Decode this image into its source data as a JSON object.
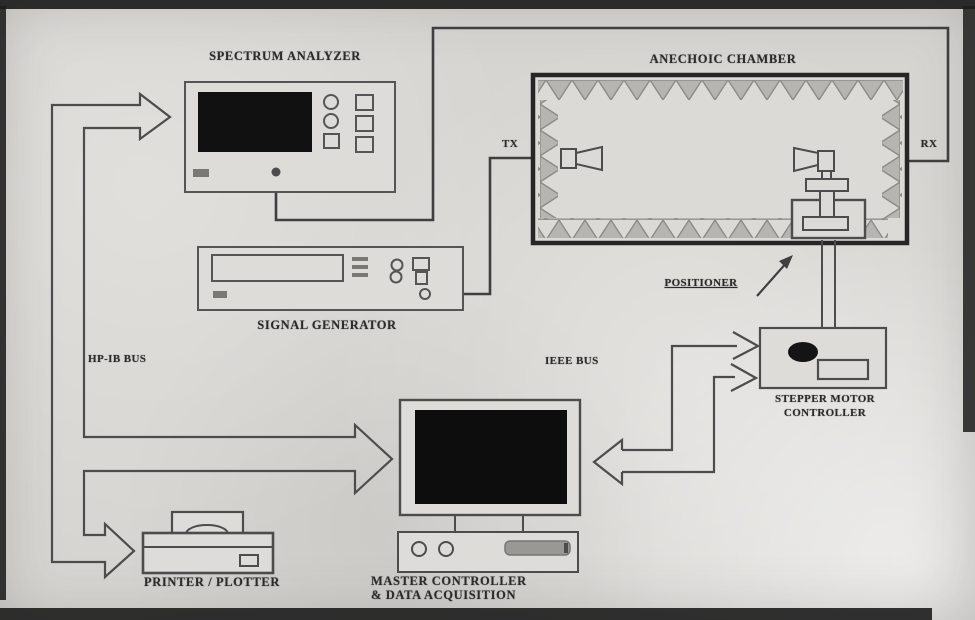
{
  "figure": {
    "labels": {
      "spectrum_analyzer": "SPECTRUM ANALYZER",
      "anechoic_chamber": "ANECHOIC CHAMBER",
      "tx": "TX",
      "rx": "RX",
      "signal_generator": "SIGNAL GENERATOR",
      "positioner": "POSITIONER",
      "hpib_bus": "HP-IB BUS",
      "ieee_bus": "IEEE BUS",
      "stepper_motor_line1": "STEPPER MOTOR",
      "stepper_motor_line2": "CONTROLLER",
      "master_controller_line1": "MASTER CONTROLLER",
      "master_controller_line2": "& DATA ACQUISITION",
      "printer_plotter": "PRINTER / PLOTTER"
    },
    "nodes": [
      {
        "id": "spectrum_analyzer",
        "label": "SPECTRUM ANALYZER"
      },
      {
        "id": "anechoic_chamber",
        "label": "ANECHOIC CHAMBER"
      },
      {
        "id": "tx_antenna",
        "label": "TX"
      },
      {
        "id": "rx_antenna",
        "label": "RX"
      },
      {
        "id": "signal_generator",
        "label": "SIGNAL GENERATOR"
      },
      {
        "id": "positioner",
        "label": "POSITIONER"
      },
      {
        "id": "stepper_motor_controller",
        "label": "STEPPER MOTOR CONTROLLER"
      },
      {
        "id": "master_controller",
        "label": "MASTER CONTROLLER & DATA ACQUISITION"
      },
      {
        "id": "printer_plotter",
        "label": "PRINTER / PLOTTER"
      }
    ],
    "connections": [
      {
        "from": "hp_ib_bus",
        "to": "spectrum_analyzer",
        "type": "hollow-bus-arrow"
      },
      {
        "from": "hp_ib_bus",
        "to": "master_controller",
        "type": "hollow-bus-arrow"
      },
      {
        "from": "hp_ib_bus",
        "to": "printer_plotter",
        "type": "hollow-bus-arrow"
      },
      {
        "from": "ieee_bus",
        "to": "stepper_motor_controller",
        "type": "line-arrows"
      },
      {
        "from": "ieee_bus",
        "to": "master_controller",
        "type": "hollow-arrow"
      },
      {
        "from": "signal_generator",
        "to": "tx_antenna",
        "type": "cable"
      },
      {
        "from": "rx_antenna",
        "to": "spectrum_analyzer",
        "type": "cable"
      },
      {
        "from": "stepper_motor_controller",
        "to": "positioner",
        "type": "shaft"
      },
      {
        "from": "positioner_label",
        "to": "positioner",
        "type": "pointer-arrow"
      }
    ],
    "colors": {
      "paper": "#d7d5d1",
      "equipment_fill": "#dedcd8",
      "ink": "#4c4c4c",
      "bold_ink": "#262626",
      "scan_border": "#1d1d1d",
      "screen": "#111111",
      "wedge_fill": "#b7b5b1",
      "slot_gray": "#9a9895"
    }
  }
}
